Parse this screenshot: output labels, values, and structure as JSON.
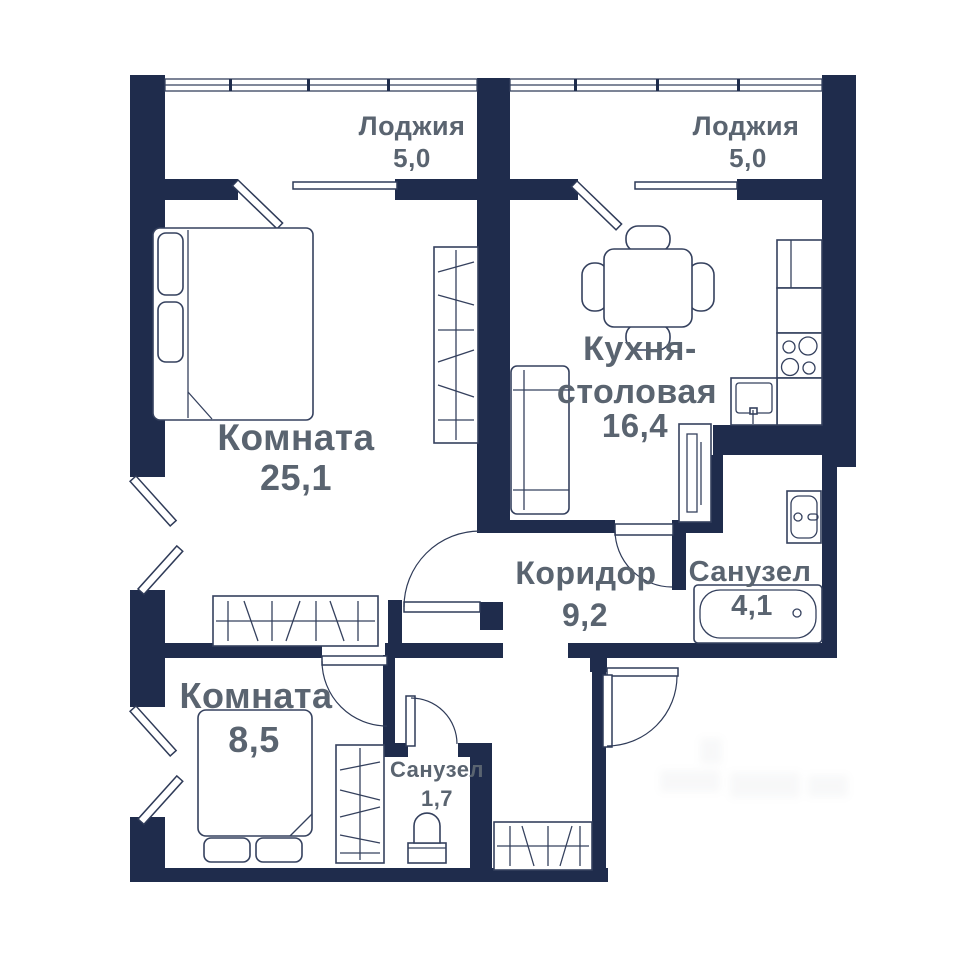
{
  "plan": {
    "type": "apartment-floor-plan",
    "rooms": {
      "loggia_left": {
        "name": "Лоджия",
        "area": "5,0"
      },
      "loggia_right": {
        "name": "Лоджия",
        "area": "5,0"
      },
      "room_main": {
        "name": "Комната",
        "area": "25,1"
      },
      "kitchen": {
        "line1": "Кухня-",
        "line2": "столовая",
        "area": "16,4"
      },
      "corridor": {
        "name": "Коридор",
        "area": "9,2"
      },
      "bathroom_big": {
        "name": "Санузел",
        "area": "4,1"
      },
      "room_small": {
        "name": "Комната",
        "area": "8,5"
      },
      "bathroom_small": {
        "name": "Санузел",
        "area": "1,7"
      }
    },
    "colors": {
      "wall": "#1f2c4c",
      "furniture_line": "#35415e",
      "label_text": "#5a6470",
      "background": "#ffffff"
    }
  }
}
